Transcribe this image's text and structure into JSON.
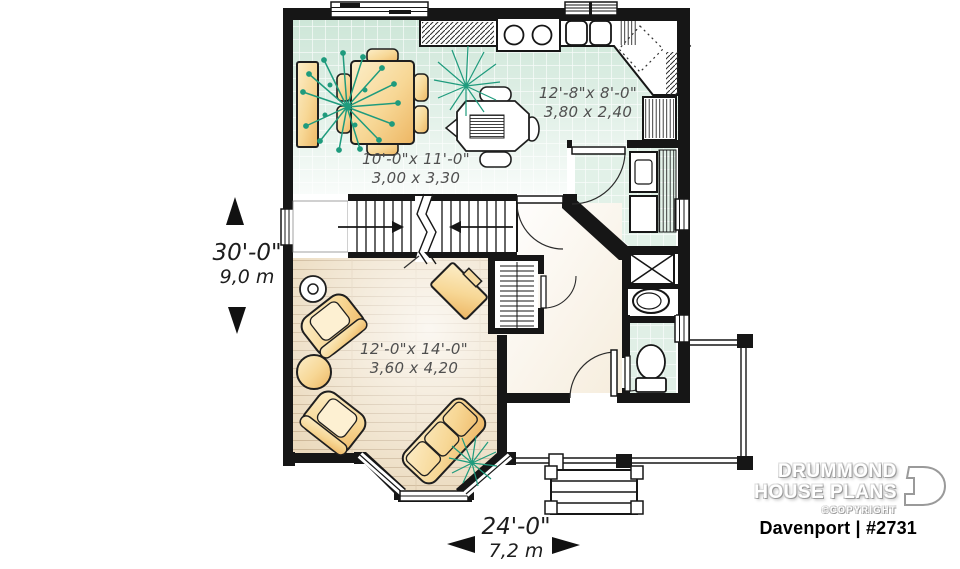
{
  "floor_plan": {
    "rooms": [
      {
        "id": "kitchen",
        "size_imperial": "12'-8\"x 8'-0\"",
        "size_metric": "3,80 x 2,40"
      },
      {
        "id": "dining",
        "size_imperial": "10'-0\"x 11'-0\"",
        "size_metric": "3,00 x 3,30"
      },
      {
        "id": "living",
        "size_imperial": "12'-0\"x 14'-0\"",
        "size_metric": "3,60 x 4,20"
      }
    ],
    "overall": {
      "depth_imperial": "30'-0\"",
      "depth_metric": "9,0 m",
      "width_imperial": "24'-0\"",
      "width_metric": "7,2 m"
    }
  },
  "branding": {
    "studio_line1": "DRUMMOND",
    "studio_line2": "HOUSE PLANS",
    "copyright": "©COPYRIGHT",
    "plan_title": "Davenport | #2731"
  },
  "colors": {
    "wall": "#161616",
    "tile": "#cbe5d6",
    "wood": "#ebdabd",
    "furniture": "#f3cd85",
    "plant": "#1f9b7d"
  }
}
